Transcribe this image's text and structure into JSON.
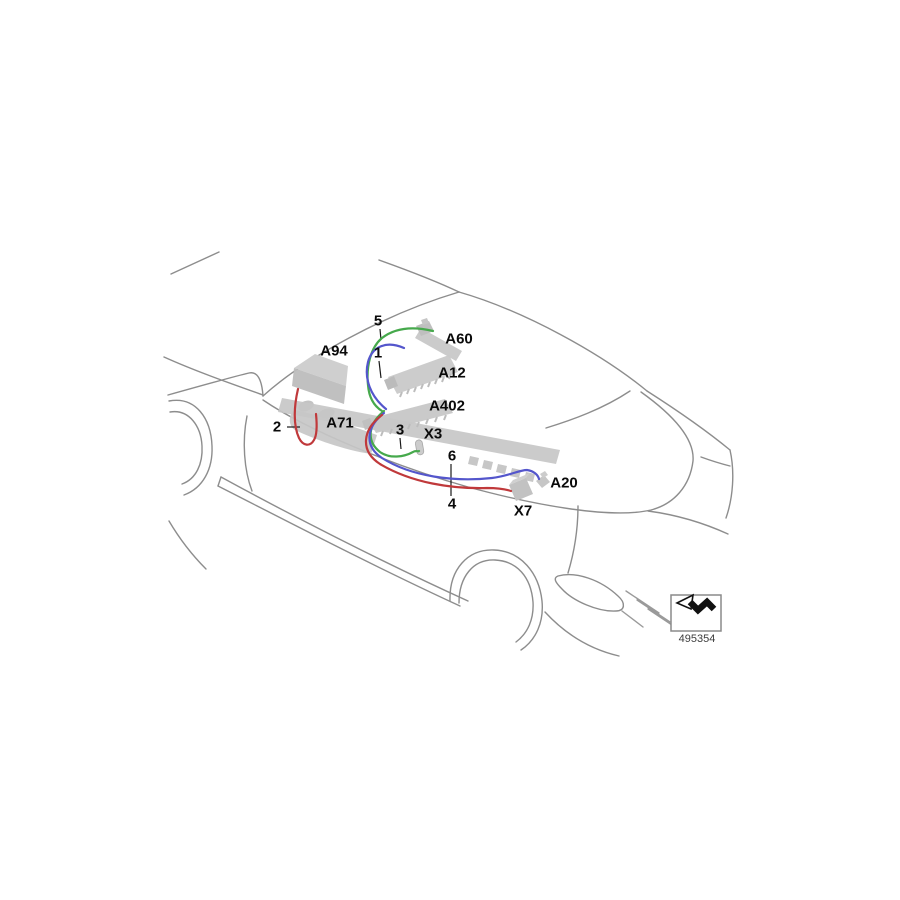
{
  "diagram": {
    "component_labels": [
      {
        "text": "A94"
      },
      {
        "text": "A60"
      },
      {
        "text": "A12"
      },
      {
        "text": "A402"
      },
      {
        "text": "A71"
      },
      {
        "text": "X3"
      },
      {
        "text": "A20"
      },
      {
        "text": "X7"
      }
    ],
    "callout_numbers": [
      {
        "text": "5"
      },
      {
        "text": "1"
      },
      {
        "text": "2"
      },
      {
        "text": "3"
      },
      {
        "text": "6"
      },
      {
        "text": "4"
      }
    ],
    "stamp": {
      "number": "495354",
      "icon": "direction-of-travel-arrow-icon"
    },
    "colors": {
      "outline_gray": "#8d8d8d",
      "component_fill": "#c7c7c7",
      "wire_green": "#46a94c",
      "wire_blue": "#5456cc",
      "wire_red": "#c0393b",
      "label_text": "#0a0a0a"
    }
  }
}
